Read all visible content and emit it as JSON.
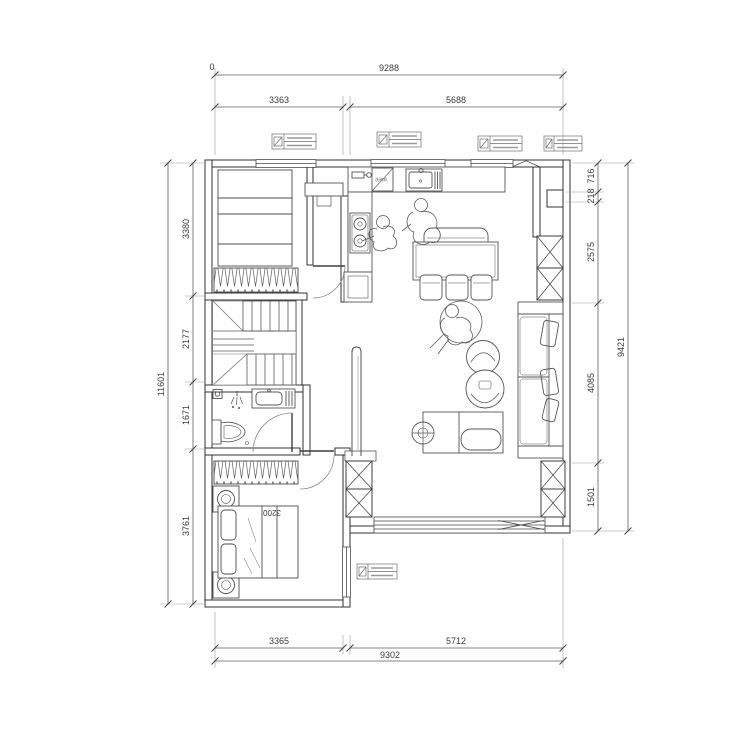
{
  "drawing": {
    "type": "residential floor plan (CAD)",
    "units": "mm"
  },
  "labels": {
    "origin": "0",
    "bed_length": "3200",
    "kitchen_appliance": "洗碗机"
  },
  "dimensions": {
    "top": {
      "overall": "9288",
      "seg_left": "3363",
      "seg_right": "5688"
    },
    "bottom": {
      "overall": "9302",
      "seg_left": "3365",
      "seg_right": "5712"
    },
    "left": {
      "overall": "11601",
      "seg1": "3380",
      "seg2": "2177",
      "seg3": "1671",
      "seg4": "3761"
    },
    "right": {
      "overall": "9421",
      "seg1": "716",
      "seg2": "218",
      "seg3": "2575",
      "seg4": "4085",
      "seg5": "1501"
    }
  },
  "colors": {
    "wall": "#303030",
    "furniture": "#555555",
    "dimension": "#5f5f5f",
    "background": "#ffffff"
  }
}
